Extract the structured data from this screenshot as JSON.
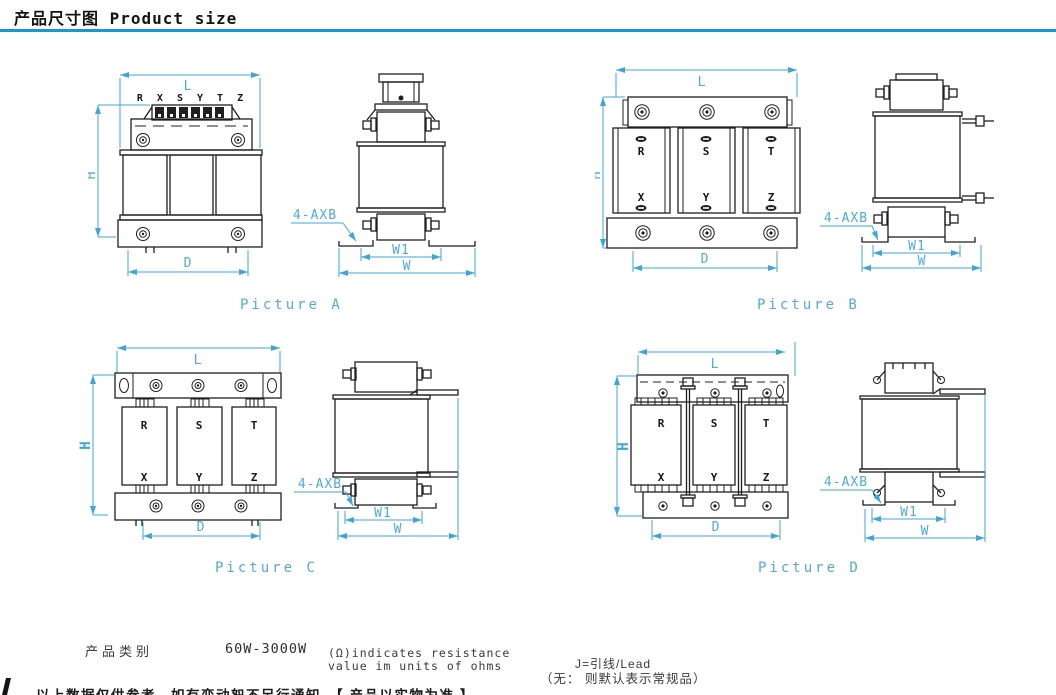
{
  "header": {
    "title": "产品尺寸图 Product size",
    "accent_color": "#1798d5"
  },
  "colors": {
    "dimension": "#3fa6d8",
    "line": "#1c1c1c",
    "caption": "#54a9da"
  },
  "figures": [
    {
      "id": "A",
      "caption": "Picture A",
      "terminal_labels": "R X S Y T Z",
      "dims": {
        "L": "L",
        "H": "H",
        "D": "D",
        "W1": "W1",
        "W": "W"
      },
      "callout": "4-AXB"
    },
    {
      "id": "B",
      "caption": "Picture B",
      "phases_top": [
        "R",
        "S",
        "T"
      ],
      "phases_bottom": [
        "X",
        "Y",
        "Z"
      ],
      "dims": {
        "L": "L",
        "H": "H",
        "D": "D",
        "W1": "W1",
        "W": "W"
      },
      "callout": "4-AXB"
    },
    {
      "id": "C",
      "caption": "Picture C",
      "phases_top": [
        "R",
        "S",
        "T"
      ],
      "phases_bottom": [
        "X",
        "Y",
        "Z"
      ],
      "dims": {
        "L": "L",
        "H": "H",
        "D": "D",
        "W1": "W1",
        "W": "W"
      },
      "callout": "4-AXB"
    },
    {
      "id": "D",
      "caption": "Picture D",
      "phases_top": [
        "R",
        "S",
        "T"
      ],
      "phases_bottom": [
        "X",
        "Y",
        "Z"
      ],
      "dims": {
        "L": "L",
        "H": "H",
        "D": "D",
        "W1": "W1",
        "W": "W"
      },
      "callout": "4-AXB"
    }
  ],
  "footer": {
    "category_label": "产品类别",
    "power_range": "60W-3000W",
    "ohm_note_line1": "(Ω)indicates resistance",
    "ohm_note_line2": "value im units of ohms",
    "lead_note": "J=引线/Lead",
    "default_note": "（无： 则默认表示常规品）",
    "disclaimer": "以上数据仅供参考，如有变动恕不另行通知，【 产品以实物为准 】"
  }
}
